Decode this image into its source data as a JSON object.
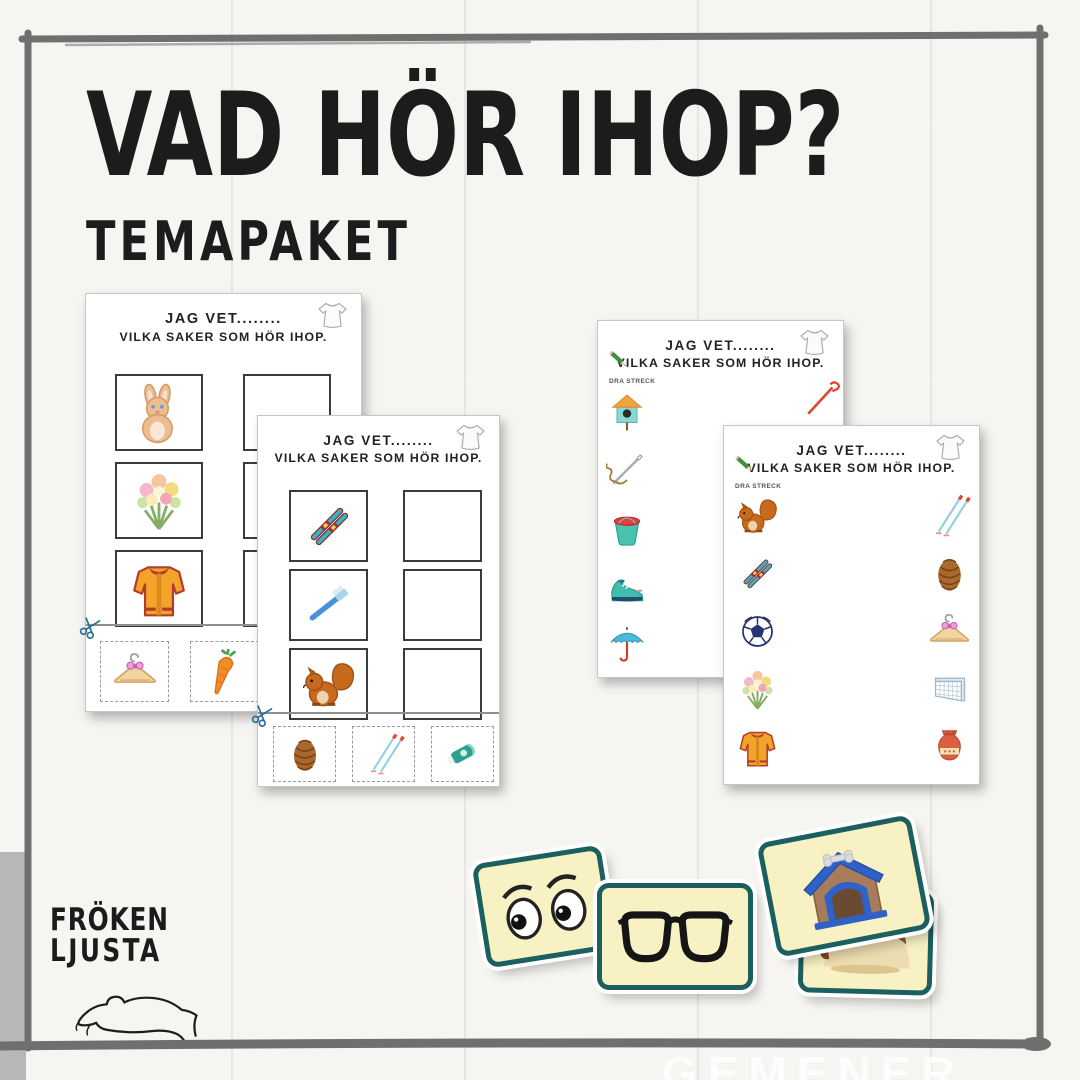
{
  "page": {
    "title": "VAD HÖR IHOP?",
    "subtitle": "TEMAPAKET",
    "watermark": "GEMENER"
  },
  "colors": {
    "frame": "#6f6f6f",
    "ink": "#1c1c1c",
    "card_border": "#1b5f5f",
    "card_fill": "#f8f1c4",
    "paper": "#ffffff"
  },
  "logo": {
    "line1": "FRÖKEN",
    "line2": "LJUSTA",
    "hand_icon": "open-hand-icon"
  },
  "worksheets": [
    {
      "name": "cut-and-paste-worksheet-1",
      "type": "match-boxes",
      "heading1": "JAG VET........",
      "heading2": "VILKA SAKER SOM HÖR IHOP.",
      "corner_icon": "shirt",
      "scissors_icon": "scissors",
      "left_items": [
        "rabbit",
        "flower-bouquet",
        "jacket"
      ],
      "right_empty_boxes": 3,
      "cutout_items": [
        "hanger",
        "carrot"
      ]
    },
    {
      "name": "cut-and-paste-worksheet-2",
      "type": "match-boxes",
      "heading1": "JAG VET........",
      "heading2": "VILKA SAKER SOM HÖR IHOP.",
      "corner_icon": "shirt",
      "scissors_icon": "scissors",
      "left_items": [
        "skis",
        "toothbrush",
        "squirrel"
      ],
      "right_empty_boxes": 3,
      "cutout_items": [
        "pinecone",
        "ski-poles",
        "toothpaste"
      ]
    },
    {
      "name": "draw-lines-worksheet-1",
      "type": "draw-lines",
      "heading1": "JAG VET........",
      "heading2": "VILKA SAKER SOM HÖR IHOP.",
      "instruction": "DRA STRECK",
      "corner_icon": "shirt",
      "pencil_icon": "pencil",
      "left_items": [
        "birdhouse",
        "needle-and-thread",
        "bucket",
        "sneaker",
        "umbrella"
      ],
      "right_items": [
        "rake"
      ]
    },
    {
      "name": "draw-lines-worksheet-2",
      "type": "draw-lines",
      "heading1": "JAG VET........",
      "heading2": "VILKA SAKER SOM HÖR IHOP.",
      "instruction": "DRA STRECK",
      "corner_icon": "shirt",
      "pencil_icon": "pencil",
      "left_items": [
        "squirrel",
        "skis",
        "soccer-ball",
        "flower-bouquet",
        "jacket"
      ],
      "right_items": [
        "ski-poles",
        "pinecone",
        "hanger",
        "soccer-goal",
        "vase"
      ]
    }
  ],
  "cards": [
    {
      "icon": "eyes"
    },
    {
      "icon": "glasses"
    },
    {
      "icon": "doghouse"
    },
    {
      "icon": "dog"
    }
  ]
}
